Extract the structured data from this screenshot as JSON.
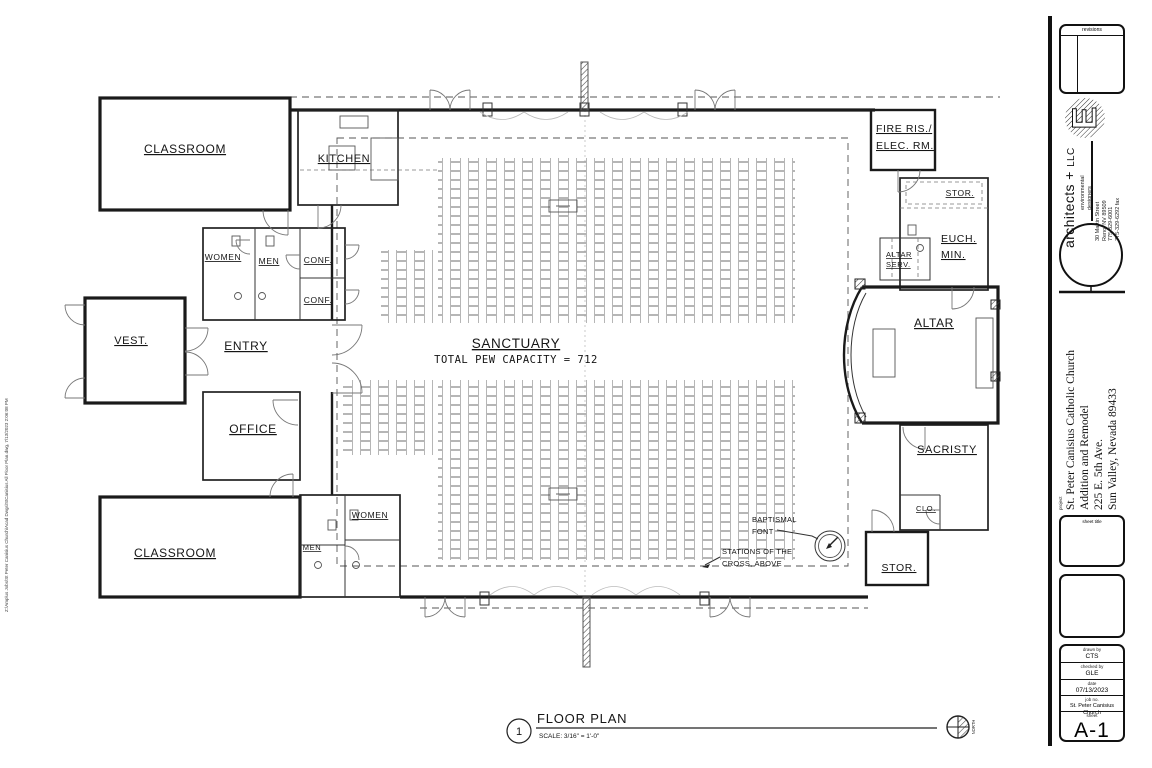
{
  "plot_stamp": "Z:\\Amplus Jobs\\St Peter Canisius Church\\Acad Dwgs\\StCanisius All Floor Plan.dwg, 7/13/2023 2:06:08 PM",
  "plan": {
    "rooms": {
      "classroom_top": "CLASSROOM",
      "kitchen": "KITCHEN",
      "women_top": "WOMEN",
      "men_top": "MEN",
      "conf_top": "CONF.",
      "conf_bottom": "CONF.",
      "vest": "VEST.",
      "entry": "ENTRY",
      "office": "OFFICE",
      "classroom_bottom": "CLASSROOM",
      "men_bottom": "MEN",
      "women_bottom": "WOMEN",
      "sanctuary": "SANCTUARY",
      "pew_capacity": "TOTAL PEW CAPACITY = 712",
      "fire_line1": "FIRE RIS./",
      "fire_line2": "ELEC. RM.",
      "stor_top": "STOR.",
      "euch_line1": "EUCH.",
      "euch_line2": "MIN.",
      "altar_serv_line1": "ALTAR",
      "altar_serv_line2": "SERV.",
      "altar": "ALTAR",
      "sacristy": "SACRISTY",
      "clo": "CLO.",
      "stor_bottom": "STOR."
    },
    "annotations": {
      "baptismal_line1": "BAPTISMAL",
      "baptismal_line2": "FONT",
      "stations_line1": "STATIONS OF THE",
      "stations_line2": "CROSS, ABOVE"
    },
    "title": {
      "number": "1",
      "label": "FLOOR PLAN",
      "scale": "SCALE:  3/16\" = 1'-0\"",
      "north": "NORTH"
    }
  },
  "titleblock": {
    "revisions_label": "revisions",
    "firm": {
      "logo_letter": "E",
      "name1": "architects +",
      "name2": "LLC",
      "tagline1": "environmental",
      "tagline2": "designers",
      "addr1": "30 Martin Street",
      "addr2": "Reno, NV 89509",
      "addr3": "775-329-6001",
      "addr4": "775-329-6292 fax"
    },
    "project_label": "project",
    "project_line1": "St. Peter Canisius Catholic Church",
    "project_line2": "Addition and Remodel",
    "project_line3": "225 E. 5th Ave.",
    "project_line4": "Sun Valley, Nevada 89433",
    "sheet_title_label": "sheet title",
    "drawn_by_label": "drawn by",
    "drawn_by": "CTS",
    "checked_by_label": "checked by",
    "checked_by": "GLE",
    "date_label": "date",
    "date": "07/13/2023",
    "job_label": "job no.",
    "job": "St. Peter Canisius Church",
    "sheet_label": "sheet",
    "sheet": "A-1"
  }
}
